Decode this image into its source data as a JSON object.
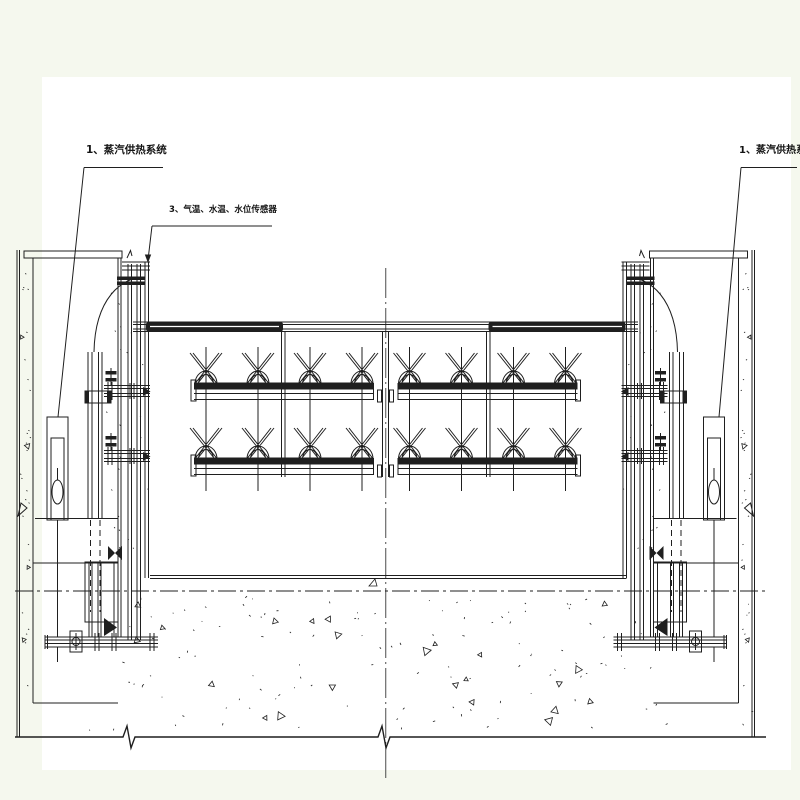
{
  "drawing": {
    "labels": {
      "steam_system_left": "1、蒸汽供热系统",
      "sensors": "3、气温、水温、水位传感器",
      "steam_system_right": "1、蒸汽供热系统"
    },
    "colors": {
      "margin": "#f5f8ee",
      "sheet": "#ffffff",
      "line": "#1f1f1f"
    }
  }
}
